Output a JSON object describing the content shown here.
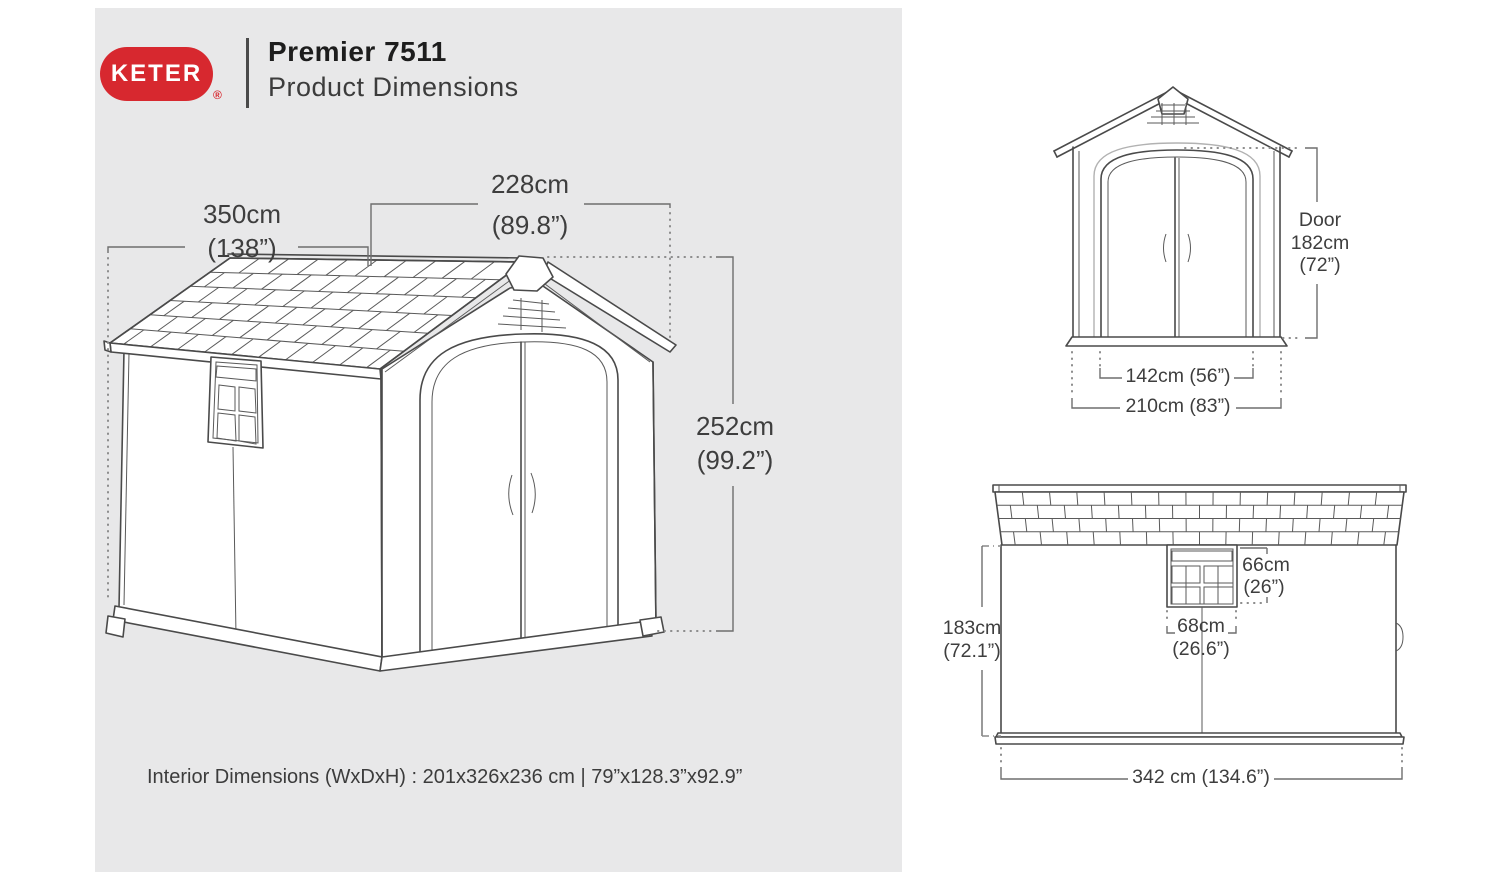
{
  "header": {
    "logo_text": "KETER",
    "registered_mark": "®",
    "title": "Premier 7511",
    "subtitle": "Product Dimensions"
  },
  "colors": {
    "brand_red": "#d7282f",
    "panel_gray": "#e8e8e9",
    "line_gray": "#4a4a4a"
  },
  "main_diagram": {
    "depth_cm": "350cm",
    "depth_in": "(138”)",
    "width_cm": "228cm",
    "width_in": "(89.8”)",
    "height_cm": "252cm",
    "height_in": "(99.2”)"
  },
  "front_view": {
    "door_label": "Door",
    "door_height_cm": "182cm",
    "door_height_in": "(72”)",
    "door_width": "142cm (56”)",
    "overall_width": "210cm (83”)"
  },
  "side_view": {
    "wall_height_cm": "183cm",
    "wall_height_in": "(72.1”)",
    "window_height_cm": "66cm",
    "window_height_in": "(26”)",
    "window_width_cm": "68cm",
    "window_width_in": "(26.6”)",
    "overall_length": "342 cm (134.6”)"
  },
  "footer": {
    "interior_dimensions": "Interior Dimensions (WxDxH) : 201x326x236 cm | 79”x128.3”x92.9”"
  }
}
